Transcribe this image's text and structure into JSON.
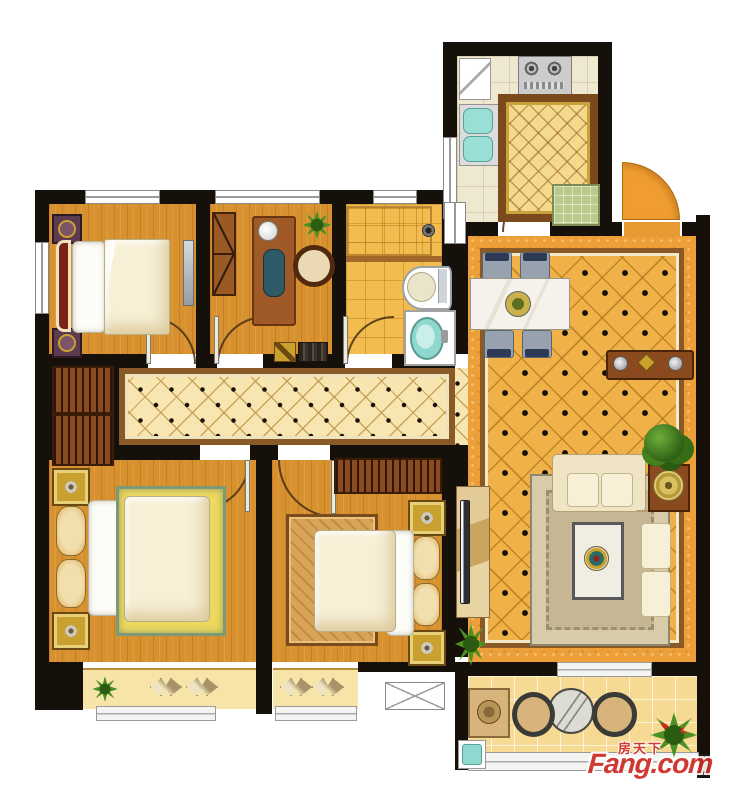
{
  "watermark": {
    "brand_cn": "房天下",
    "brand_en": "Fang.com",
    "color": "#cf2b24"
  },
  "palette": {
    "wall": "#16100a",
    "wood_floor": "#d8912f",
    "living_tile": "#f1b149",
    "hall_tile": "#f8e6b2",
    "bath_tile": "#f2bd4e",
    "balcony_tile": "#f6d992",
    "kitchen_floor": "#efe8d0",
    "frame_brown": "#8a5a26",
    "bed_cream": "#f7f0d6",
    "gold": "#c9a12f",
    "teal_fixture": "#8fd8d0",
    "plant_green": "#4d8f23",
    "entry_door_orange": "#ef9d31",
    "rug_tan": "#cfc0a0"
  },
  "rooms": [
    {
      "id": "kitchen"
    },
    {
      "id": "living-dining-room"
    },
    {
      "id": "bedroom-top-left"
    },
    {
      "id": "study"
    },
    {
      "id": "bathroom"
    },
    {
      "id": "hallway"
    },
    {
      "id": "master-bedroom"
    },
    {
      "id": "bedroom-bottom-middle"
    },
    {
      "id": "balcony"
    }
  ]
}
